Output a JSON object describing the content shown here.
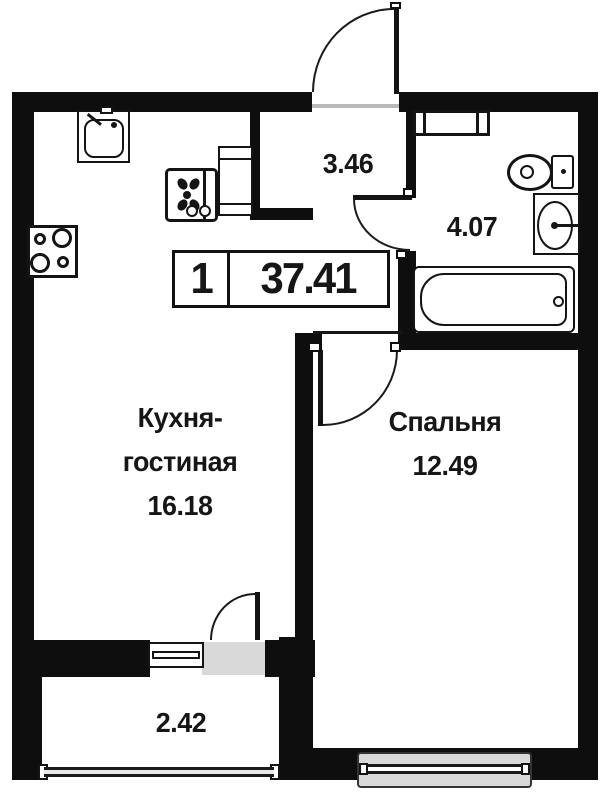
{
  "plan": {
    "title": "apartment-floor-plan",
    "badge": {
      "rooms_count": "1",
      "total_area": "37.41"
    },
    "rooms": {
      "kitchen_living": {
        "name_line1": "Кухня-",
        "name_line2": "гостиная",
        "area": "16.18"
      },
      "bedroom": {
        "name": "Спальня",
        "area": "12.49"
      },
      "hallway": {
        "area": "3.46"
      },
      "bathroom": {
        "area": "4.07"
      },
      "balcony": {
        "area": "2.42"
      }
    },
    "fixtures": [
      "kitchen-sink",
      "stove",
      "fridge",
      "hall-cabinet",
      "bathroom-cabinet",
      "toilet",
      "washbasin",
      "bathtub",
      "balcony-window",
      "bedroom-window"
    ],
    "colors": {
      "wall": "#0e0e0e",
      "window_fill": "#d9d9d9",
      "text": "#161616"
    }
  }
}
